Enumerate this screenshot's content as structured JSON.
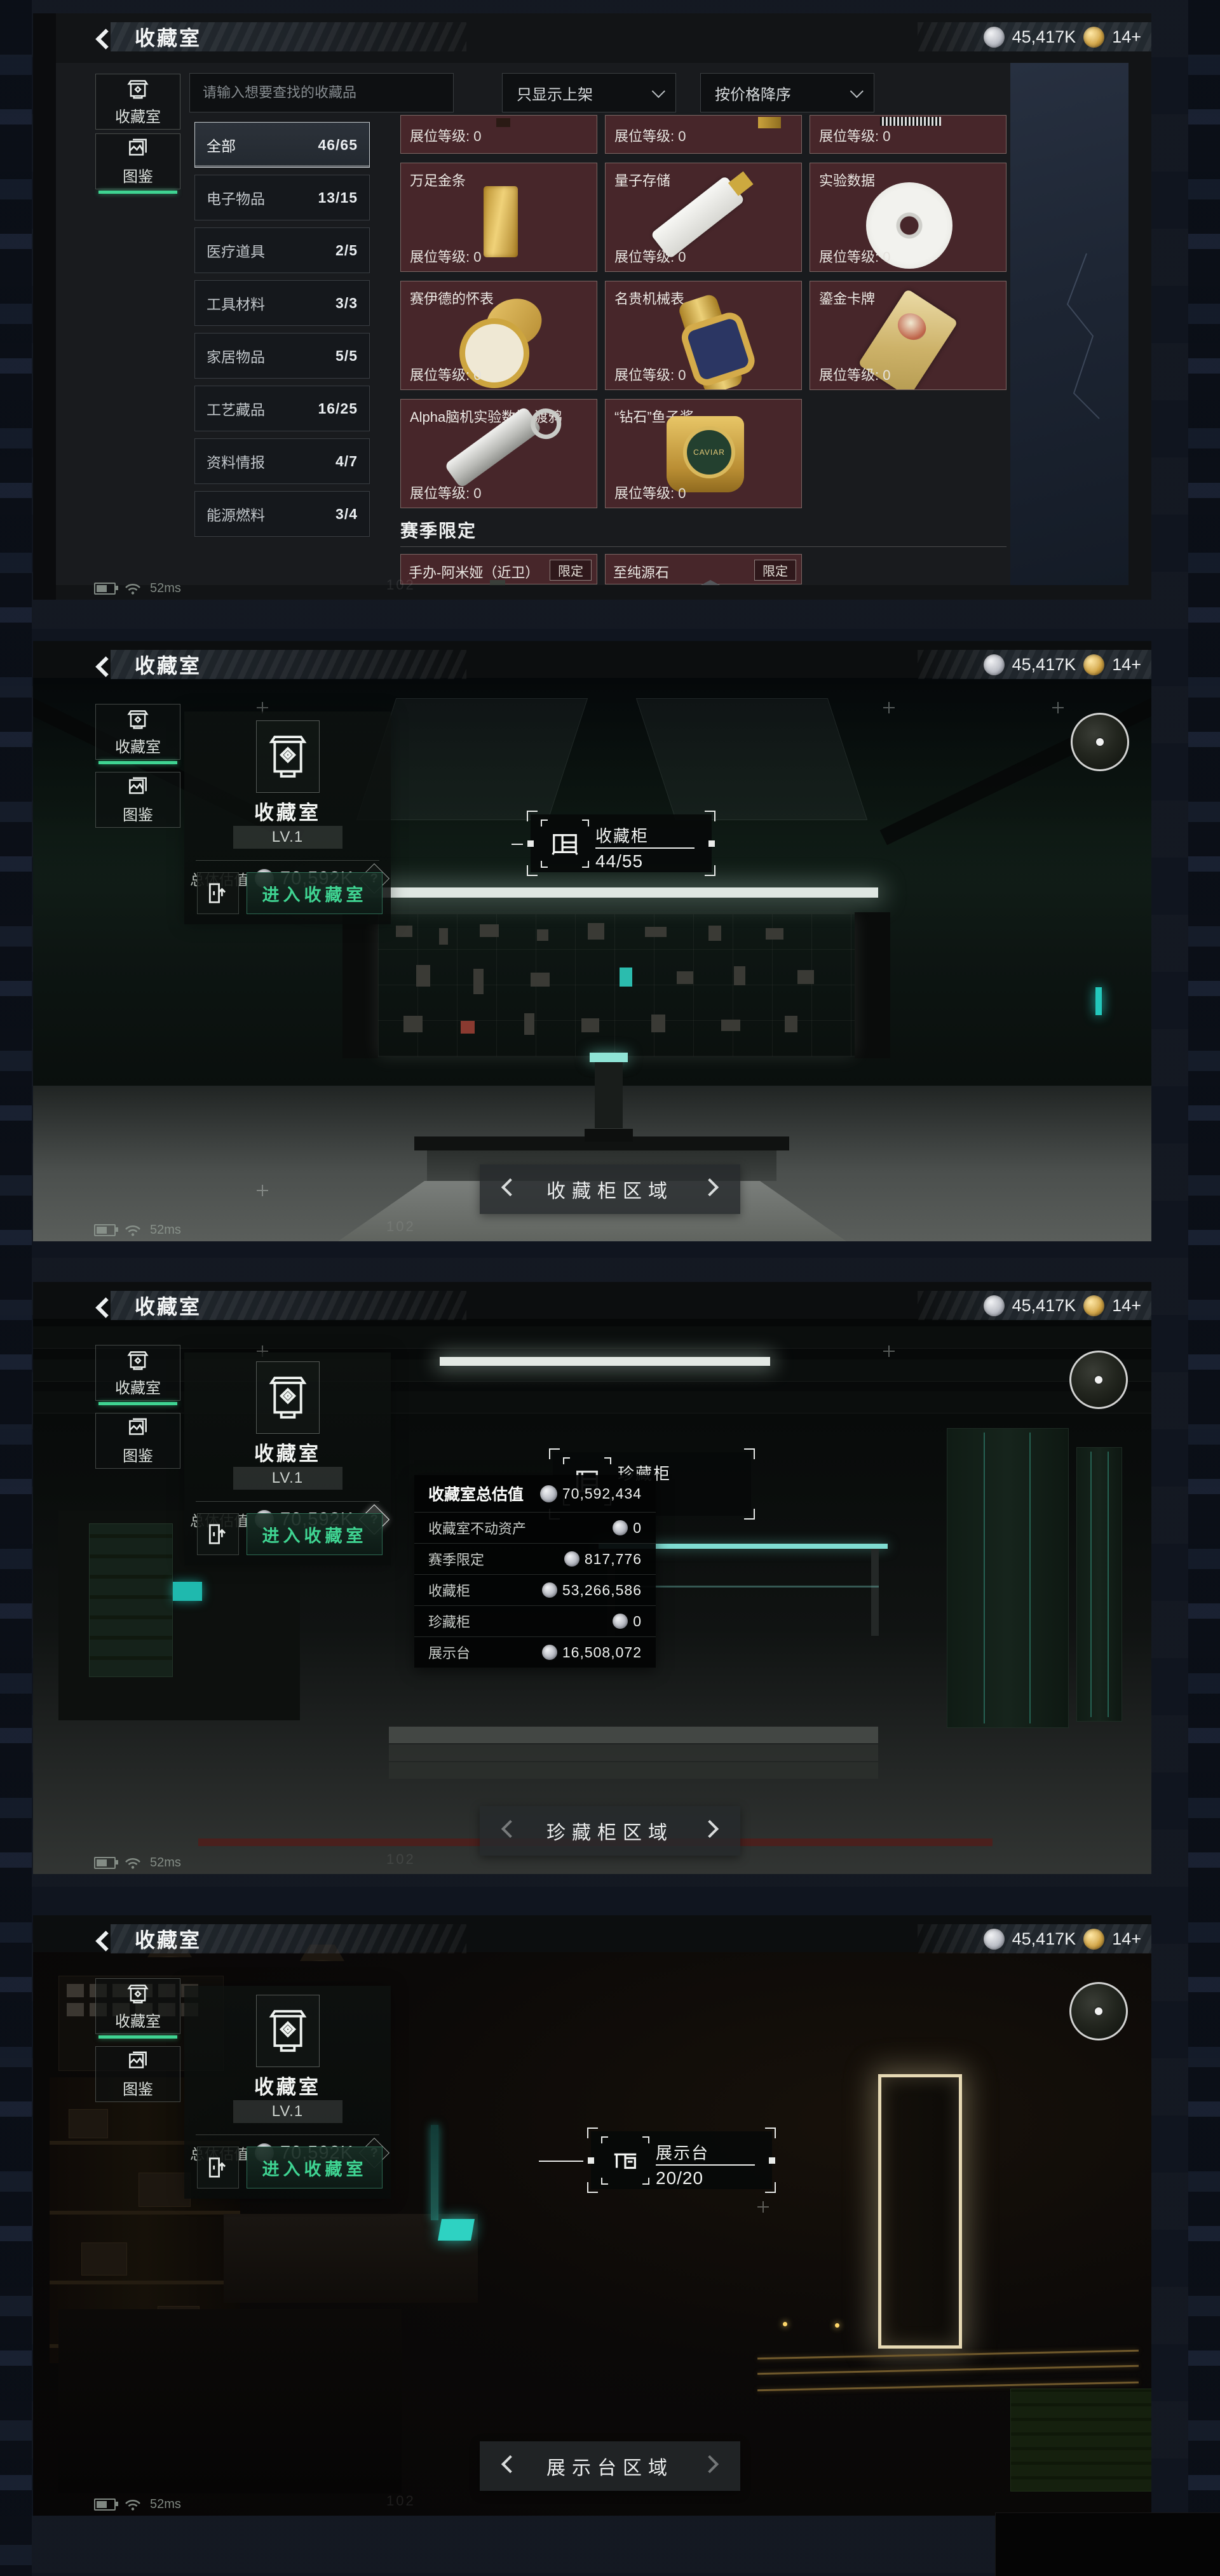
{
  "header": {
    "title": "收藏室",
    "money": "45,417K",
    "gold": "14+"
  },
  "colors": {
    "accent_green": "#3fd492",
    "teal": "#2bd0c0",
    "card_red": "#47262a",
    "gold_coin": "#c79a3a",
    "panel_dark": "#17191c",
    "bg_navy": "#10151f"
  },
  "p1": {
    "search_placeholder": "请输入想要查找的收藏品",
    "filter_listed": "只显示上架",
    "filter_sort": "按价格降序",
    "tabs": [
      {
        "label": "收藏室"
      },
      {
        "label": "图鉴"
      }
    ],
    "categories": [
      {
        "label": "全部",
        "count": "46/65"
      },
      {
        "label": "电子物品",
        "count": "13/15"
      },
      {
        "label": "医疗道具",
        "count": "2/5"
      },
      {
        "label": "工具材料",
        "count": "3/3"
      },
      {
        "label": "家居物品",
        "count": "5/5"
      },
      {
        "label": "工艺藏品",
        "count": "16/25"
      },
      {
        "label": "资料情报",
        "count": "4/7"
      },
      {
        "label": "能源燃料",
        "count": "3/4"
      }
    ],
    "level_label": "展位等级: 0",
    "items": [
      {
        "name": "万足金条",
        "level": "展位等级: 0"
      },
      {
        "name": "量子存储",
        "level": "展位等级: 0"
      },
      {
        "name": "实验数据",
        "level": "展位等级: 0"
      },
      {
        "name": "赛伊德的怀表",
        "level": "展位等级: 0"
      },
      {
        "name": "名贵机械表",
        "level": "展位等级: 0"
      },
      {
        "name": "鎏金卡牌",
        "level": "展位等级: 0"
      },
      {
        "name": "Alpha脑机实验数据-渡鸦",
        "level": "展位等级: 0"
      },
      {
        "name": "“钻石”鱼子酱",
        "level": "展位等级: 0"
      }
    ],
    "caviar_label": "CAVIAR",
    "season": {
      "title": "赛季限定",
      "items": [
        {
          "name": "手办-阿米娅（近卫）",
          "tag": "限定"
        },
        {
          "name": "至纯源石",
          "tag": "限定"
        }
      ]
    }
  },
  "room": {
    "title": "收藏室",
    "level": "LV.1",
    "value_label": "总体估值",
    "value": "70,592K",
    "help": "?",
    "enter": "进入收藏室"
  },
  "p2": {
    "tooltip": {
      "title": "收藏柜",
      "count": "44/55"
    },
    "nav": "收藏柜区域"
  },
  "p3": {
    "tooltip_title": "珍藏柜",
    "nav": "珍藏柜区域",
    "breakdown": {
      "title": "收藏室总估值",
      "total": "70,592,434",
      "rows": [
        {
          "label": "收藏室不动资产",
          "value": "0"
        },
        {
          "label": "赛季限定",
          "value": "817,776"
        },
        {
          "label": "收藏柜",
          "value": "53,266,586"
        },
        {
          "label": "珍藏柜",
          "value": "0"
        },
        {
          "label": "展示台",
          "value": "16,508,072"
        }
      ]
    }
  },
  "p4": {
    "tooltip": {
      "title": "展示台",
      "count": "20/20"
    },
    "nav": "展示台区域"
  },
  "status": {
    "ping": "52ms"
  },
  "watermark": "102"
}
